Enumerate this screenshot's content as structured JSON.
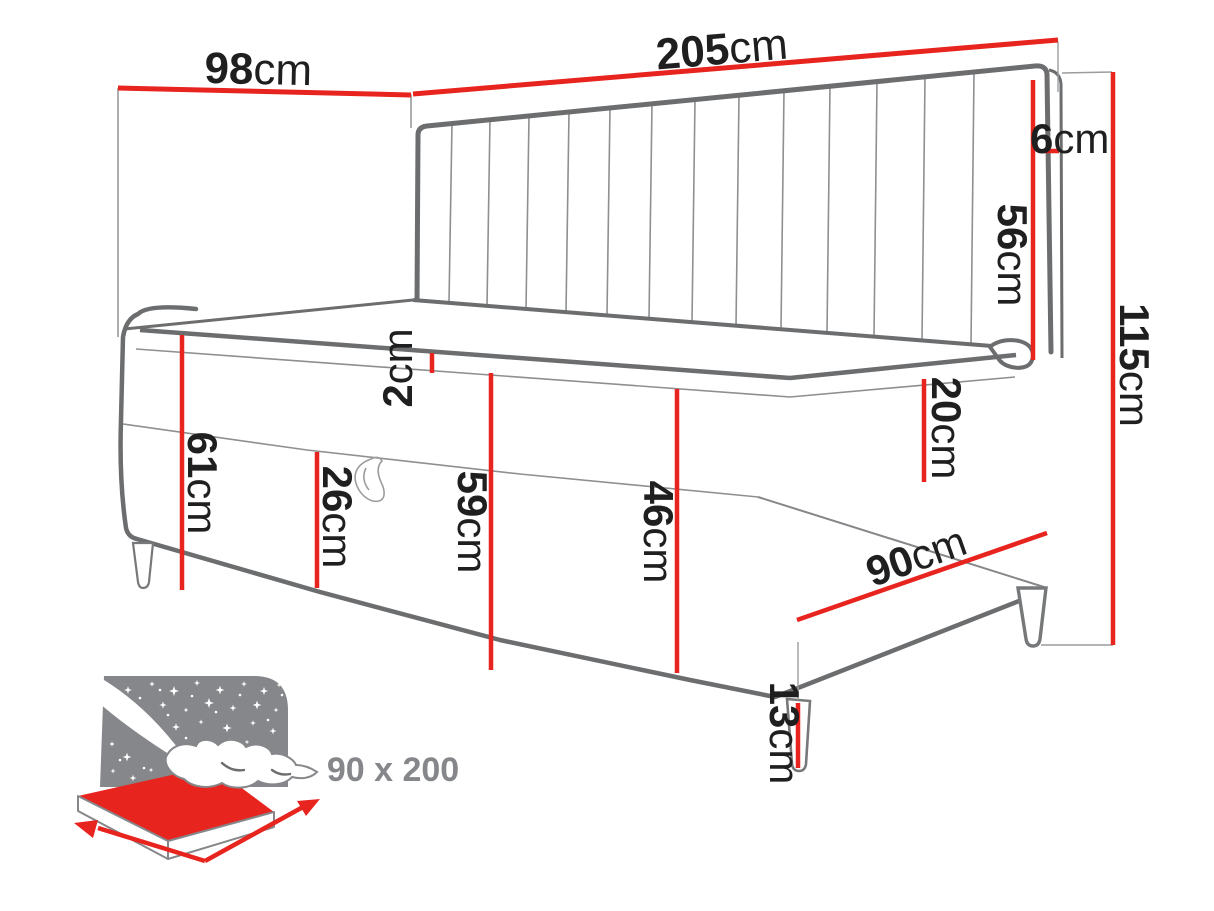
{
  "diagram": {
    "dims": {
      "d98": {
        "v": "98",
        "u": "cm"
      },
      "d205": {
        "v": "205",
        "u": "cm"
      },
      "d6": {
        "v": "6",
        "u": "cm"
      },
      "d56": {
        "v": "56",
        "u": "cm"
      },
      "d115": {
        "v": "115",
        "u": "cm"
      },
      "d61": {
        "v": "61",
        "u": "cm"
      },
      "d2": {
        "v": "2",
        "u": "cm"
      },
      "d26": {
        "v": "26",
        "u": "cm"
      },
      "d59": {
        "v": "59",
        "u": "cm"
      },
      "d46": {
        "v": "46",
        "u": "cm"
      },
      "d20": {
        "v": "20",
        "u": "cm"
      },
      "d90": {
        "v": "90",
        "u": "cm"
      },
      "d13": {
        "v": "13",
        "u": "cm"
      }
    },
    "badge": {
      "size": "90 x 200"
    },
    "colors": {
      "dimension_red": "#e8241f",
      "outline_gray": "#6b6d6f",
      "thin_gray": "#9a9c9e",
      "icon_gray": "#85878a",
      "label_black": "#1f1f1f"
    }
  }
}
